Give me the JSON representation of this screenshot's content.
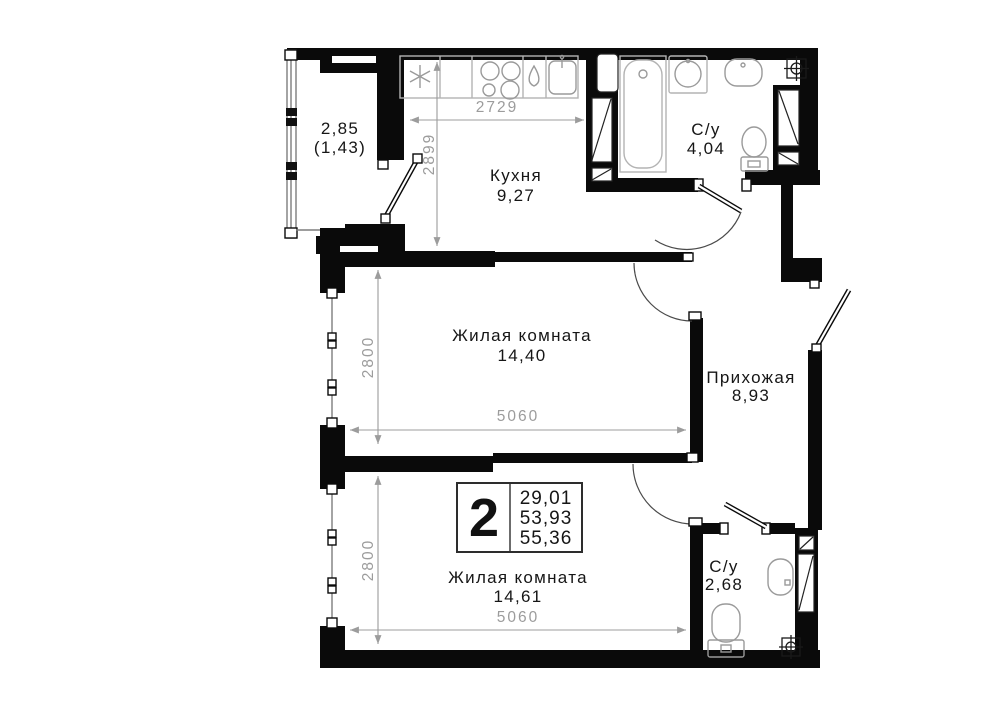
{
  "rooms": {
    "balcony": {
      "area": "2,85",
      "area_reduced": "(1,43)"
    },
    "kitchen": {
      "name": "Кухня",
      "area": "9,27"
    },
    "bathroom_top": {
      "name": "С/у",
      "area": "4,04"
    },
    "living_1": {
      "name": "Жилая комната",
      "area": "14,40"
    },
    "hallway": {
      "name": "Прихожая",
      "area": "8,93"
    },
    "living_2": {
      "name": "Жилая комната",
      "area": "14,61"
    },
    "bathroom_bottom": {
      "name": "С/у",
      "area": "2,68"
    }
  },
  "dimensions_mm": {
    "kitchen_width": "2729",
    "kitchen_depth": "2899",
    "living_1_depth": "2800",
    "living_1_width": "5060",
    "living_2_depth": "2800",
    "living_2_width": "5060"
  },
  "info_badge": {
    "rooms_count": "2",
    "areas": [
      "29,01",
      "53,93",
      "55,36"
    ]
  },
  "colors": {
    "wall": "#0a0a0a",
    "dimension": "#9c9c9c",
    "fixture": "#b3b3b3"
  }
}
